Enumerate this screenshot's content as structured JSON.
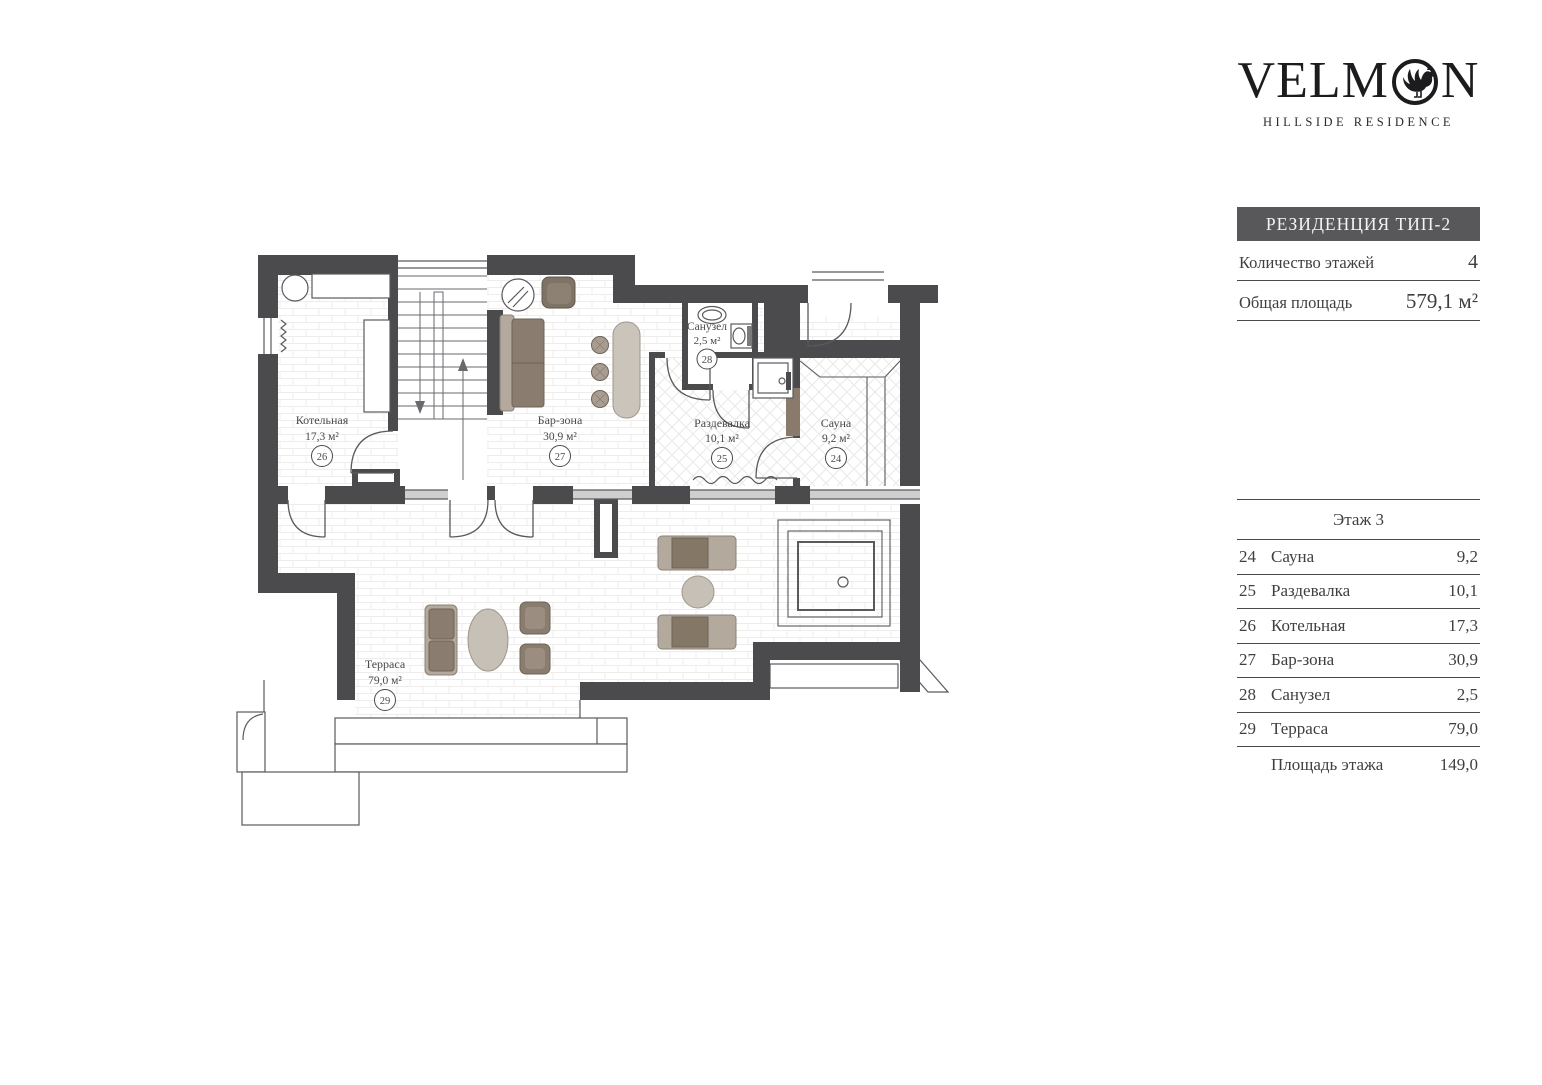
{
  "brand": {
    "name_start": "VELM",
    "name_end": "N",
    "o_icon": "rooster-in-ring-icon",
    "tagline": "HILLSIDE RESIDENCE"
  },
  "panel": {
    "title": "РЕЗИДЕНЦИЯ ТИП-2",
    "info_rows": [
      {
        "label": "Количество этажей",
        "value": "4"
      },
      {
        "label": "Общая площадь",
        "value": "579,1 м²"
      }
    ],
    "table": {
      "header": "Этаж 3",
      "rows": [
        {
          "num": "24",
          "name": "Сауна",
          "area": "9,2"
        },
        {
          "num": "25",
          "name": "Раздевалка",
          "area": "10,1"
        },
        {
          "num": "26",
          "name": "Котельная",
          "area": "17,3"
        },
        {
          "num": "27",
          "name": "Бар-зона",
          "area": "30,9"
        },
        {
          "num": "28",
          "name": "Санузел",
          "area": "2,5"
        },
        {
          "num": "29",
          "name": "Терраса",
          "area": "79,0"
        }
      ],
      "footer": {
        "label": "Площадь этажа",
        "value": "149,0"
      }
    }
  },
  "plan": {
    "rooms": [
      {
        "num": "24",
        "name": "Сауна",
        "area": "9,2 м²"
      },
      {
        "num": "25",
        "name": "Раздевалка",
        "area": "10,1 м²"
      },
      {
        "num": "26",
        "name": "Котельная",
        "area": "17,3 м²"
      },
      {
        "num": "27",
        "name": "Бар-зона",
        "area": "30,9 м²"
      },
      {
        "num": "28",
        "name": "Санузел",
        "area": "2,5 м²"
      },
      {
        "num": "29",
        "name": "Терраса",
        "area": "79,0 м²"
      }
    ],
    "colors": {
      "wall": "#4b4b4d",
      "line": "#5a5a5e",
      "furniture_dark": "#8a7c6e",
      "furniture_light": "#b3aa9d",
      "table_tan": "#c6c0b6"
    }
  }
}
